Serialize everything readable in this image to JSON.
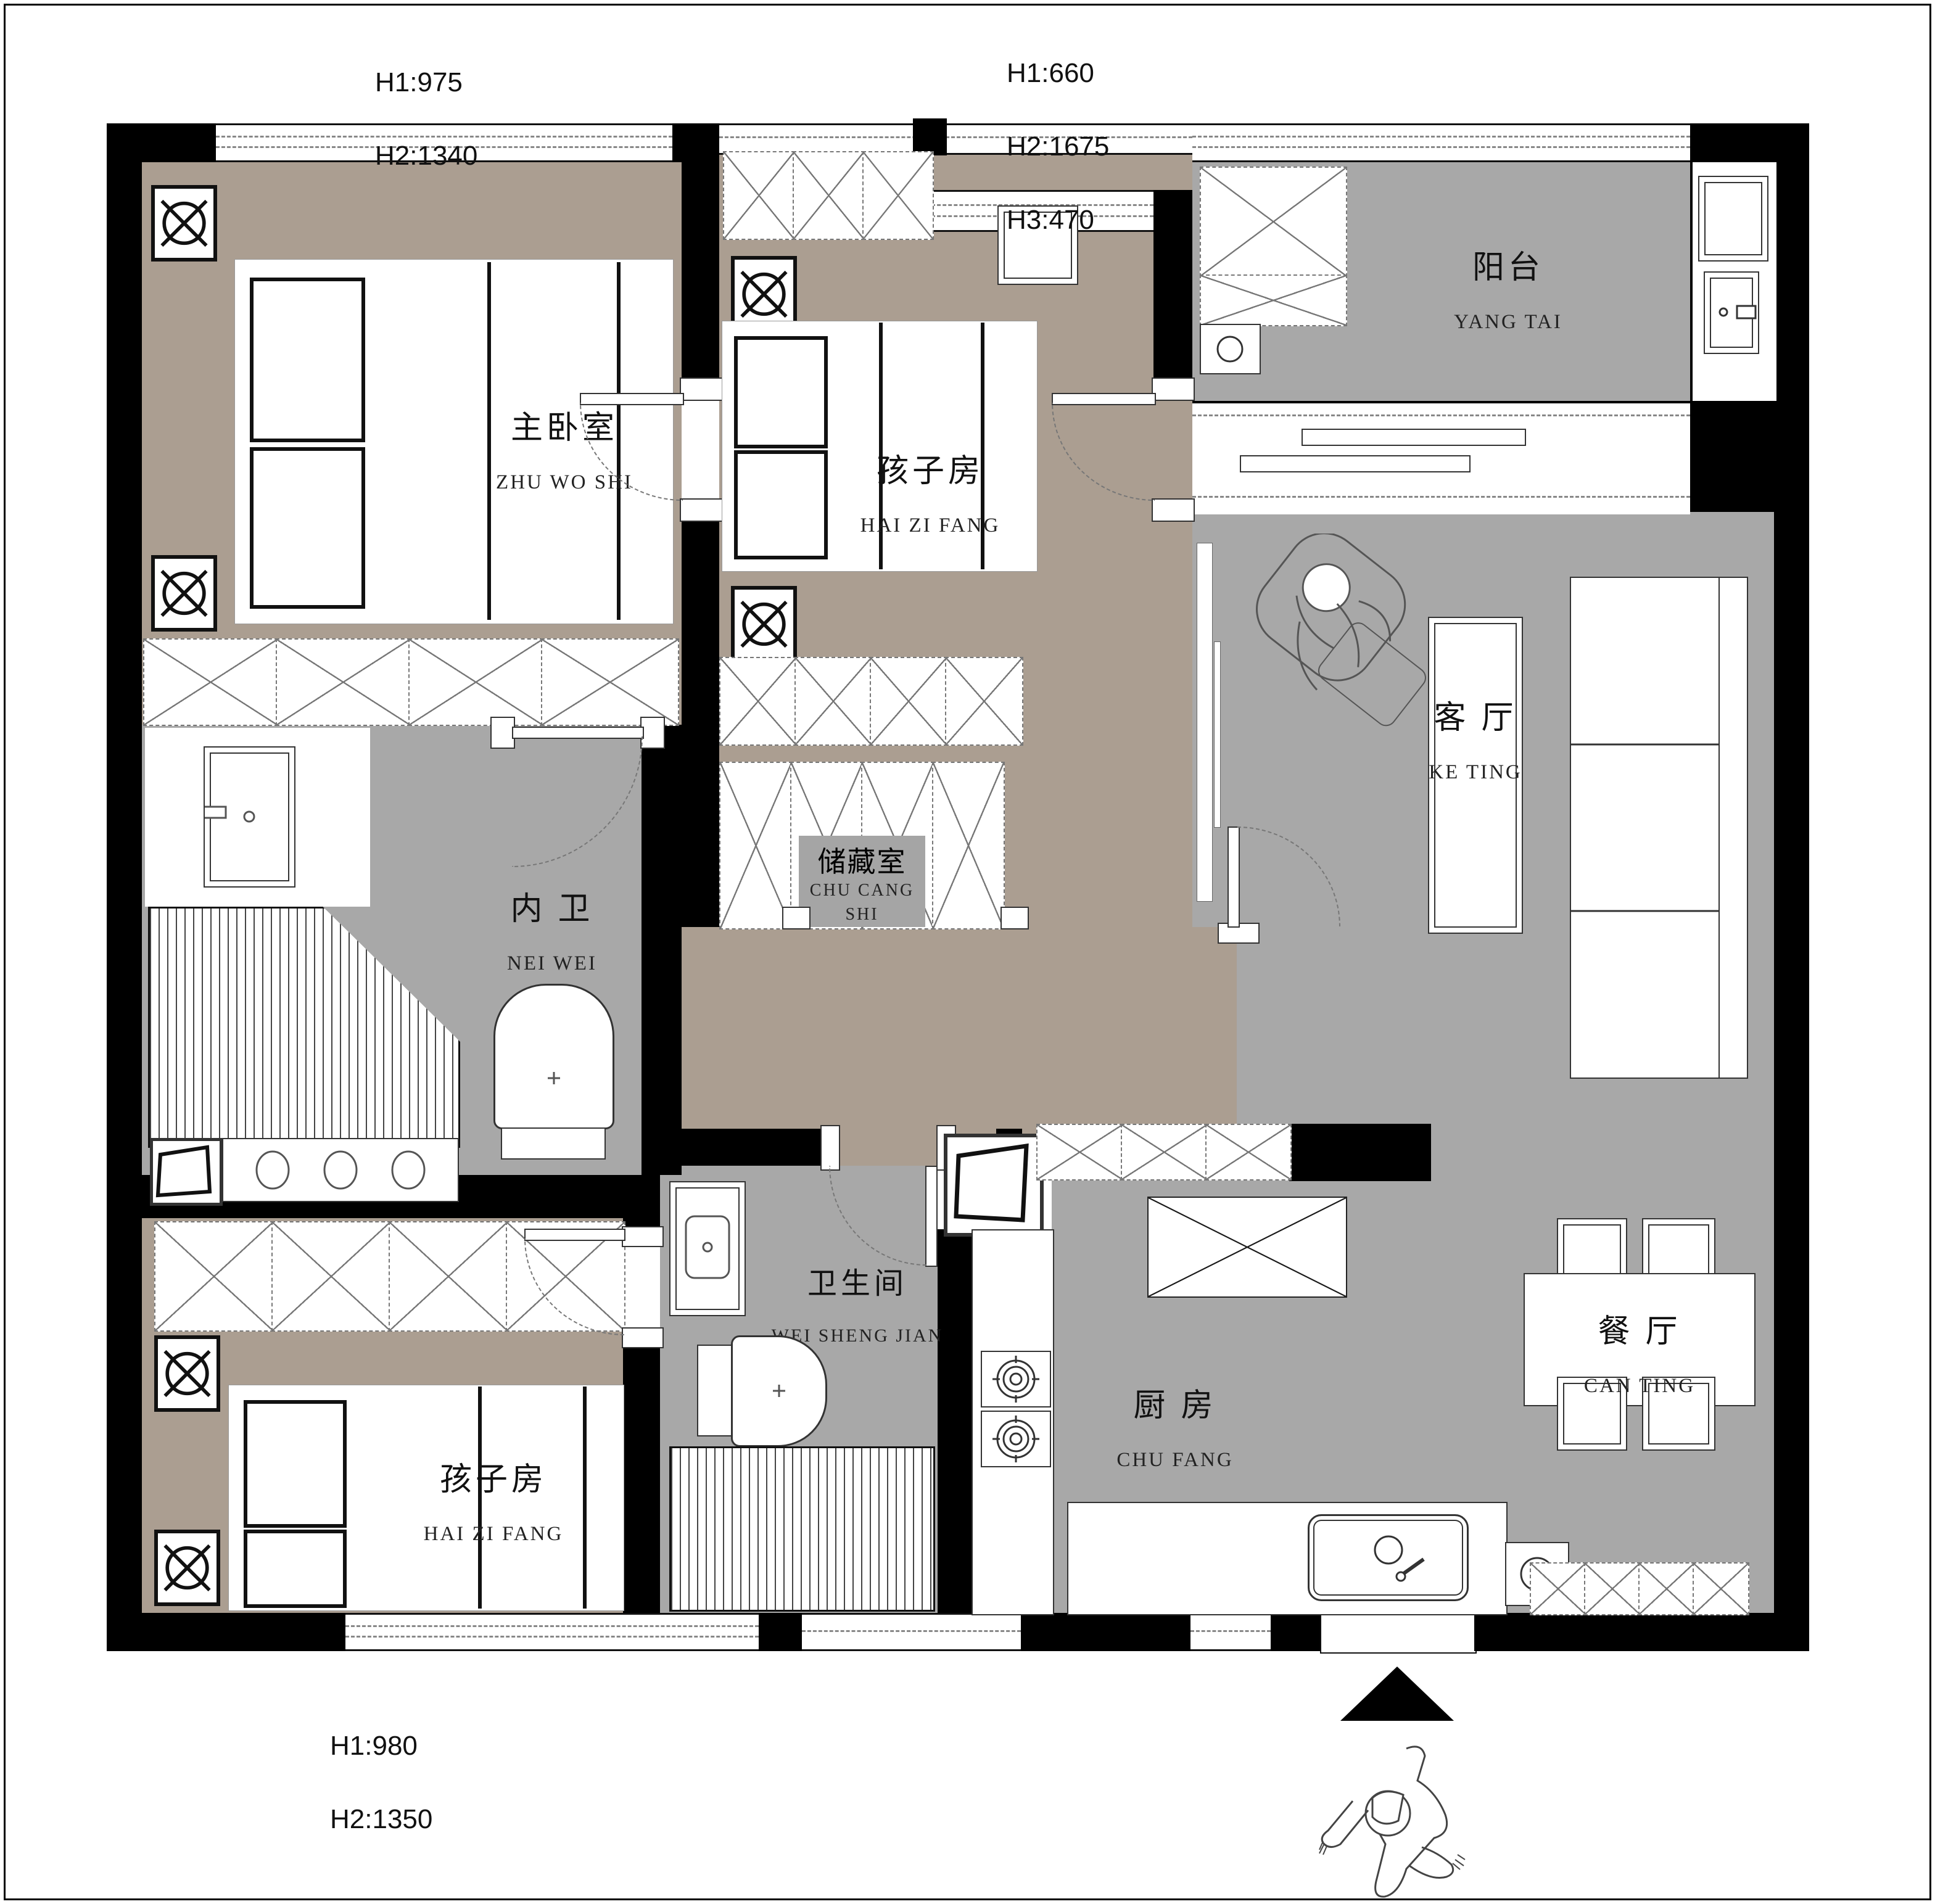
{
  "drawing": {
    "type": "residential floor plan",
    "colors": {
      "wall": "#000000",
      "bedroom_floor": "#ab9e91",
      "public_floor": "#a8a8a8",
      "background": "#ffffff"
    }
  },
  "dims": {
    "top_left": [
      "H1:975",
      "H2:1340"
    ],
    "top_middle": [
      "H1:660",
      "H2:1675",
      "H3:470"
    ],
    "bottom_left": [
      "H1:980",
      "H2:1350"
    ]
  },
  "rooms": {
    "master": {
      "zh": "主卧室",
      "py": "ZHU WO SHI"
    },
    "child_north": {
      "zh": "孩子房",
      "py": "HAI ZI FANG"
    },
    "balcony": {
      "zh": "阳台",
      "py": "YANG TAI"
    },
    "living": {
      "zh": "客 厅",
      "py": "KE TING"
    },
    "inner_bath": {
      "zh": "内 卫",
      "py": "NEI WEI"
    },
    "storage": {
      "zh": "储藏室",
      "py": "CHU CANG SHI"
    },
    "bathroom": {
      "zh": "卫生间",
      "py": "WEI SHENG JIAN"
    },
    "kitchen": {
      "zh": "厨 房",
      "py": "CHU FANG"
    },
    "child_south": {
      "zh": "孩子房",
      "py": "HAI ZI FANG"
    },
    "dining": {
      "zh": "餐 厅",
      "py": "CAN TING"
    }
  }
}
